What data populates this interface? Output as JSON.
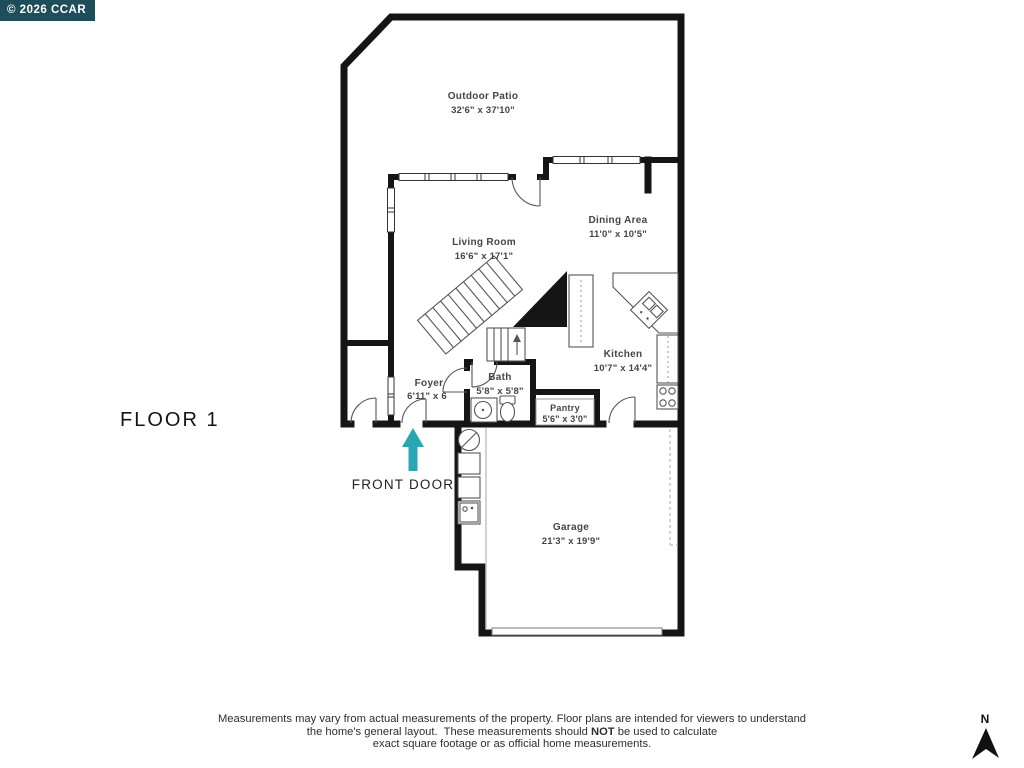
{
  "watermark": {
    "text": "© 2026 CCAR",
    "bg_color": "#1D4E5A"
  },
  "floor": {
    "label": "FLOOR 1"
  },
  "front_door": {
    "label": "FRONT DOOR",
    "arrow_color": "#2AA5B4"
  },
  "rooms": {
    "outdoor_patio": {
      "name": "Outdoor Patio",
      "dims": "32'6\" x 37'10\""
    },
    "living_room": {
      "name": "Living Room",
      "dims": "16'6\" x 17'1\""
    },
    "dining_area": {
      "name": "Dining Area",
      "dims": "11'0\" x 10'5\""
    },
    "kitchen": {
      "name": "Kitchen",
      "dims": "10'7\" x 14'4\""
    },
    "bath": {
      "name": "Bath",
      "dims": "5'8\" x 5'8\""
    },
    "foyer": {
      "name": "Foyer",
      "dims": "6'11\" x 6"
    },
    "pantry": {
      "name": "Pantry",
      "dims": "5'6\" x 3'0\""
    },
    "garage": {
      "name": "Garage",
      "dims": "21'3\" x 19'9\""
    }
  },
  "compass": {
    "label": "N"
  },
  "disclaimer": {
    "line1": "Measurements may vary from actual measurements of the property. Floor plans are intended for viewers to understand",
    "line2_pre": "the home's general layout.  These measurements should ",
    "line2_bold": "NOT",
    "line2_post": " be used to calculate",
    "line3": "exact square footage or as official home measurements."
  },
  "colors": {
    "wall": "#151515",
    "accent_teal": "#2AA5B4"
  }
}
